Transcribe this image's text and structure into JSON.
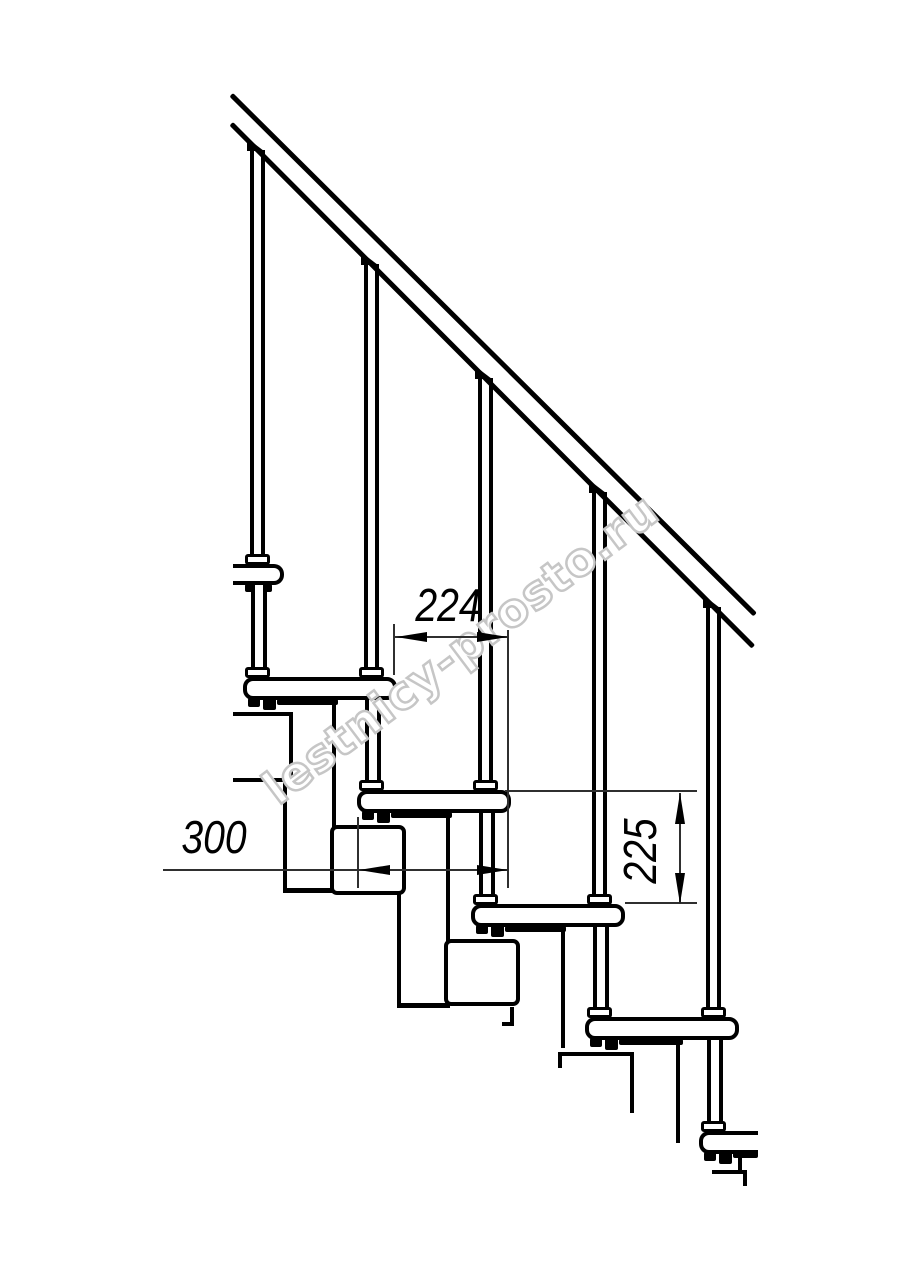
{
  "page": {
    "background": "#ffffff",
    "width_px": 914,
    "height_px": 1280
  },
  "drawing": {
    "description": "Side elevation of a modular staircase: diagonal handrail, five balusters, six visible treads with stacked step modules",
    "line_color": "#000000",
    "dimensions": [
      {
        "name": "step-run",
        "value": "224",
        "orientation": "horizontal"
      },
      {
        "name": "tread-depth",
        "value": "300",
        "orientation": "horizontal"
      },
      {
        "name": "step-rise",
        "value": "225",
        "orientation": "vertical"
      }
    ],
    "watermark": {
      "text": "lestnicy-prosto.ru",
      "stroke_color": "#c6c6c6",
      "fill_color": "#ffffff",
      "rotation_deg": -37
    },
    "counts": {
      "treads_visible": 6,
      "balusters": 5
    }
  }
}
